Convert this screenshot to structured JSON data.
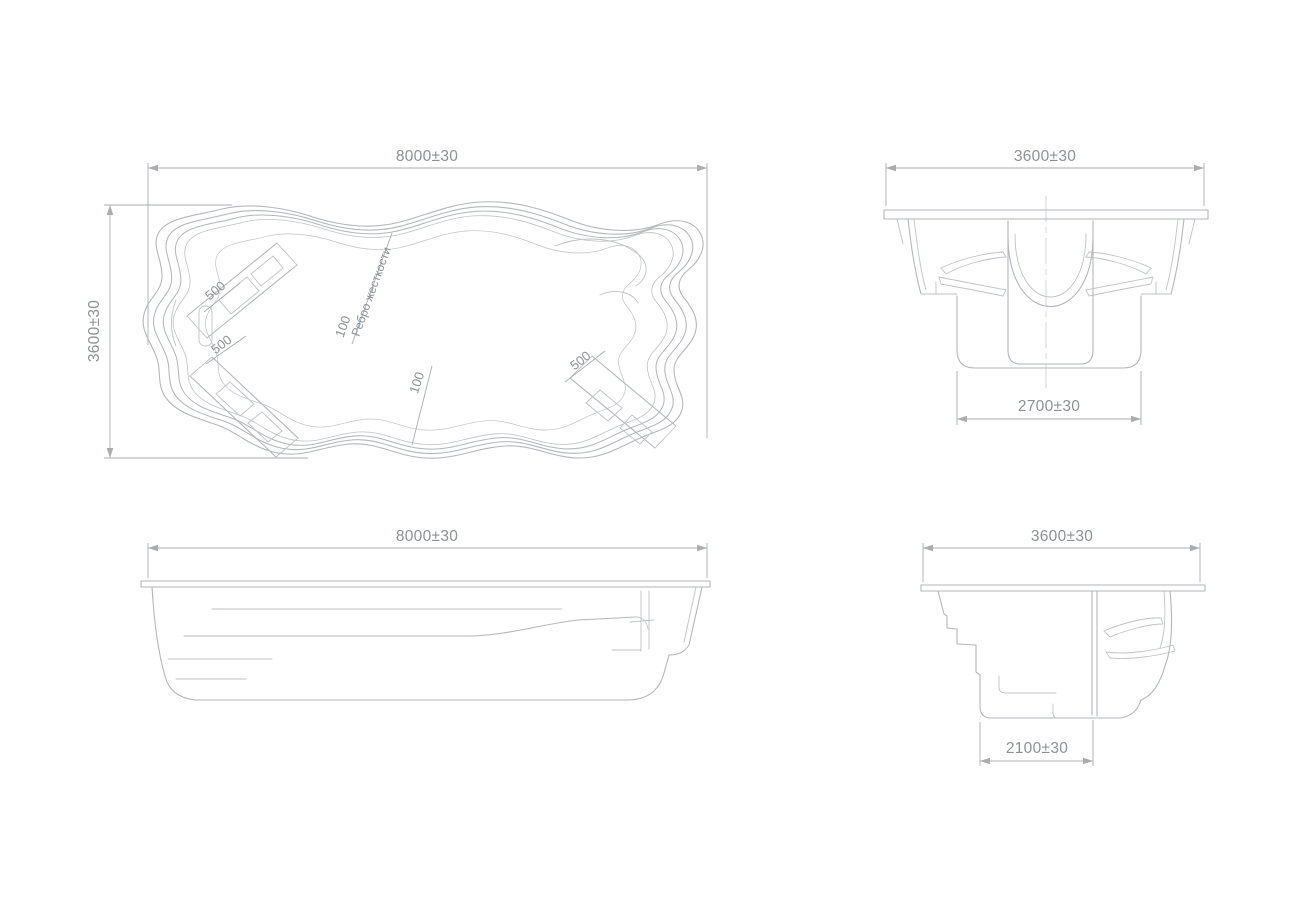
{
  "drawing": {
    "plan_view": {
      "width_dim": "8000±30",
      "height_dim": "3600±30",
      "shelf_width_top_left": "500",
      "shelf_width_bottom_left": "500",
      "shelf_width_bottom_right": "500",
      "rib_thickness_top": "100",
      "rib_thickness_bottom": "100",
      "stiffener_label": "Ребро жесткости"
    },
    "front_view": {
      "width_dim": "3600±30",
      "bottom_width_dim": "2700±30"
    },
    "side_view": {
      "width_dim": "8000±30"
    },
    "end_view": {
      "width_dim": "3600±30",
      "bottom_width_dim": "2100±30"
    }
  },
  "colors": {
    "background": "#ffffff",
    "geometry_line": "#b3b6bb",
    "dimension_line": "#a9acb1",
    "text": "#8d9196"
  }
}
